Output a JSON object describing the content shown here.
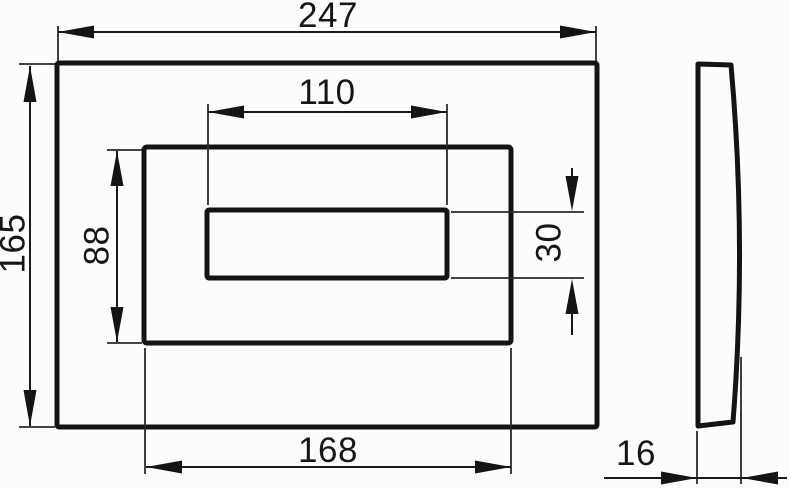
{
  "drawing": {
    "colors": {
      "background": "#fcfcfc",
      "line": "#161616"
    },
    "dimensions": {
      "outer_width": "247",
      "outer_height": "165",
      "button_frame_width": "168",
      "button_frame_height": "88",
      "slot_width": "110",
      "slot_height": "30",
      "thickness": "16"
    }
  }
}
